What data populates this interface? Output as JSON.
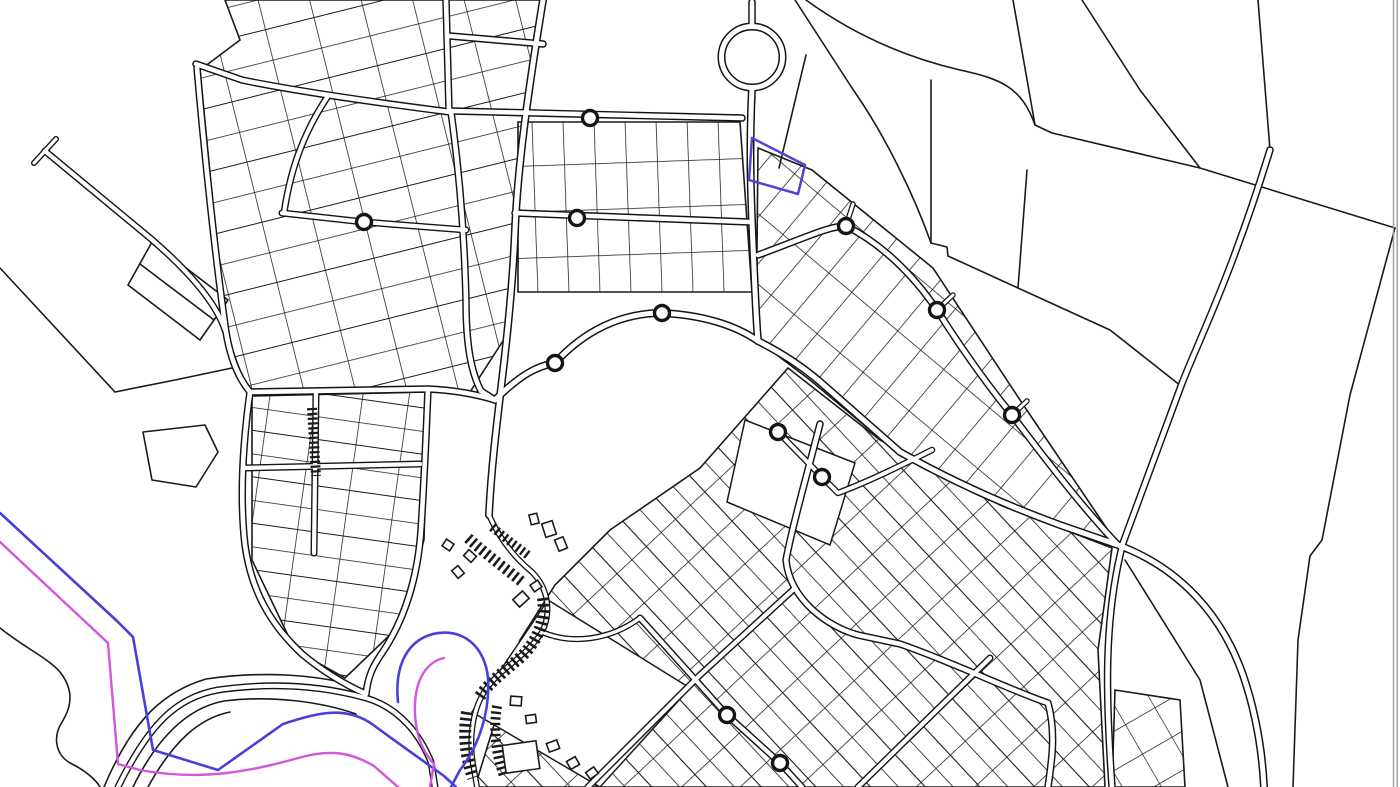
{
  "map": {
    "background": "#ffffff",
    "canvas": {
      "width": 1400,
      "height": 787
    },
    "colors": {
      "parcel_line": "#1a1a1a",
      "road_casing": "#141414",
      "road_fill": "#ffffff",
      "building_fill": "#ffffff",
      "overlay_blue": "#4a3fd8",
      "overlay_magenta": "#d356dd",
      "parcel_highlight_blue": "#5044d4",
      "frame_gray": "#9a9a9a"
    },
    "patterns": [
      {
        "id": "pat_nw",
        "w": 50,
        "h": 62,
        "rot": -14,
        "lines": [
          {
            "d": "M0 0H50",
            "w": 1.5
          },
          {
            "d": "M0 0V62",
            "w": 1.5
          },
          {
            "d": "M0 31H50",
            "w": 1.1
          }
        ]
      },
      {
        "id": "pat_nc",
        "w": 31,
        "h": 46,
        "rot": -2,
        "lines": [
          {
            "d": "M0 0H31",
            "w": 1.5
          },
          {
            "d": "M0 0V46",
            "w": 1.5
          }
        ]
      },
      {
        "id": "pat_fan",
        "w": 30,
        "h": 54,
        "rot": 40,
        "lines": [
          {
            "d": "M0 0H30",
            "w": 1.5
          },
          {
            "d": "M0 0V54",
            "w": 1.5
          }
        ]
      },
      {
        "id": "pat_se",
        "w": 40,
        "h": 40,
        "rot": -43,
        "lines": [
          {
            "d": "M0 0H40",
            "w": 1.6
          },
          {
            "d": "M0 0V40",
            "w": 1.6
          },
          {
            "d": "M20 0V40",
            "w": 1.1
          }
        ]
      },
      {
        "id": "pat_sw",
        "w": 46,
        "h": 46,
        "rot": 8,
        "lines": [
          {
            "d": "M0 0H46",
            "w": 1.5
          },
          {
            "d": "M0 0V46",
            "w": 1.5
          },
          {
            "d": "M0 23H46",
            "w": 1.1
          }
        ]
      },
      {
        "id": "pat_br",
        "w": 34,
        "h": 34,
        "rot": -30,
        "lines": [
          {
            "d": "M0 0H34",
            "w": 1.4
          },
          {
            "d": "M0 0V34",
            "w": 1.4
          }
        ]
      }
    ],
    "zones": [
      {
        "name": "zone-northwest-grid",
        "pattern": "pat_nw",
        "points": "225,0 540,0 514,230 510,330 470,392 248,392 225,330 200,70 240,40"
      },
      {
        "name": "zone-north-center-lots",
        "pattern": "pat_nc",
        "points": "518,122 740,122 752,292 518,292"
      },
      {
        "name": "zone-northeast-fan",
        "pattern": "pat_fan",
        "points": "758,148 812,170 933,268 1020,400 1118,545 1015,510 900,455 810,380 757,340 757,250"
      },
      {
        "name": "zone-southeast-grid",
        "pattern": "pat_se",
        "points": "788,368 880,440 1000,505 1112,548 1098,650 1105,787 475,787 520,640 555,585 610,530 700,468"
      },
      {
        "name": "zone-southwest-grid",
        "pattern": "pat_sw",
        "points": "252,396 428,392 424,540 395,630 345,678 295,650 252,560"
      },
      {
        "name": "zone-bottom-right-lots",
        "pattern": "pat_br",
        "points": "1115,690 1180,700 1185,787 1112,787"
      }
    ],
    "white_blocks": [
      {
        "name": "empty-block-diamond",
        "d": "M548 600 L690 688 L600 787 L472 712 Z"
      },
      {
        "name": "empty-block-center",
        "d": "M745 420 L855 463 L830 545 L727 502 Z"
      }
    ],
    "parcel_lines": [
      {
        "name": "fan-field-boundary",
        "d": "M795 0 L852 88 C885 135 914 195 931 243"
      },
      {
        "name": "field-vertical-boundary",
        "d": "M931 80 L931 243"
      },
      {
        "name": "fan-step-boundary",
        "d": "M931 243 L947 247 L948 256 L1018 288"
      },
      {
        "name": "field-corner-line",
        "d": "M1027 170 L1018 288"
      },
      {
        "name": "fan-outer-edge",
        "d": "M1018 288 L1110 330 L1181 386"
      },
      {
        "name": "north-field-boundary",
        "d": "M806 0 C850 32 900 56 960 70 C1002 79 1022 88 1035 125 L1052 133 L1200 168 L1395 228"
      },
      {
        "name": "field-line-a",
        "d": "M1013 0 L1035 125"
      },
      {
        "name": "field-line-b",
        "d": "M1082 0 L1140 90 L1200 168"
      },
      {
        "name": "east-field-boundary",
        "d": "M1395 228 L1350 395 L1322 540 L1310 556 L1298 640 L1293 787"
      },
      {
        "name": "field-line-c",
        "d": "M1258 0 L1270 150"
      },
      {
        "name": "field-line-d",
        "d": "M1125 560 L1200 680 L1228 787"
      },
      {
        "name": "line-into-blue-parcel",
        "d": "M806 55 L779 168"
      },
      {
        "name": "west-open-boundary",
        "d": "M0 268 L115 392"
      },
      {
        "name": "west-open-boundary-2",
        "d": "M115 392 L175 380 L232 368"
      },
      {
        "name": "pentagon-parcel",
        "d": "M143 432 L205 425 L218 452 L196 487 L152 480 Z"
      },
      {
        "name": "quad-parcel",
        "d": "M152 242 L228 300 L200 340 L128 285 Z"
      },
      {
        "name": "quad-parcel-midline",
        "d": "M140 264 L214 320"
      },
      {
        "name": "coastline",
        "d": "M0 628 C25 648 48 658 60 672 C74 690 72 706 62 722 C52 738 56 756 72 764 C86 771 96 780 100 787"
      },
      {
        "name": "shore-road-thin-1",
        "d": "M133 787 C160 732 192 707 224 701 C272 695 322 702 356 714"
      },
      {
        "name": "shore-road-thin-2",
        "d": "M148 787 C174 740 200 718 230 712"
      },
      {
        "name": "shore-road-thin-3",
        "d": "M104 787 C134 716 166 691 206 679 C268 670 320 676 352 685"
      }
    ],
    "roads": [
      {
        "name": "road-pier-hammer",
        "d": "M34 163 L56 139",
        "casing": 6,
        "fill": 3.2
      },
      {
        "name": "road-pier",
        "d": "M45 151 L150 238 C185 268 215 300 225 330",
        "casing": 7,
        "fill": 4.2
      },
      {
        "name": "road-nw-west-edge",
        "d": "M197 68 C205 160 216 262 226 332 C231 362 240 380 250 392",
        "casing": 7.5,
        "fill": 4.6
      },
      {
        "name": "road-nw-top",
        "d": "M196 64 L242 80 C300 92 380 103 450 112",
        "casing": 7.5,
        "fill": 4.6
      },
      {
        "name": "road-nw-link",
        "d": "M450 36 L543 44",
        "casing": 7.5,
        "fill": 4.6
      },
      {
        "name": "road-nw-north-stub",
        "d": "M446 0 L449 110",
        "casing": 7.5,
        "fill": 4.6
      },
      {
        "name": "road-nw-east-edge",
        "d": "M451 112 C458 162 464 220 466 300 C466 345 471 372 481 391 L495 400",
        "casing": 7.5,
        "fill": 4.6
      },
      {
        "name": "road-nw-interior-1",
        "d": "M328 96 C302 135 290 172 284 213",
        "casing": 7,
        "fill": 4.2
      },
      {
        "name": "road-nw-interior-2",
        "d": "M282 213 L364 222 L466 230",
        "casing": 7,
        "fill": 4.2
      },
      {
        "name": "road-central-spine",
        "d": "M543 0 C530 80 518 160 515 230 C513 280 508 330 502 380 C496 430 491 472 489 515",
        "casing": 8,
        "fill": 5
      },
      {
        "name": "road-nc-upper",
        "d": "M452 111 L742 118",
        "casing": 7.5,
        "fill": 4.6
      },
      {
        "name": "road-nc-lower",
        "d": "M515 213 L749 222",
        "casing": 7.5,
        "fill": 4.6
      },
      {
        "name": "road-roundabout-stub",
        "d": "M752 2 L752 24",
        "casing": 7.5,
        "fill": 4.6
      },
      {
        "name": "road-east-ns",
        "d": "M752 88 C749 150 751 200 753 245 C755 292 756 318 758 341",
        "casing": 8,
        "fill": 5
      },
      {
        "name": "road-crescent",
        "d": "M495 400 C520 375 537 366 555 363 C585 330 622 313 662 313 C702 315 735 325 758 341",
        "casing": 8,
        "fill": 5
      },
      {
        "name": "road-sw-top",
        "d": "M250 392 L428 389 C452 390 472 393 495 400",
        "casing": 7.5,
        "fill": 4.6
      },
      {
        "name": "road-sw-west",
        "d": "M250 392 C242 450 240 502 245 545 C251 590 270 624 302 654 C326 674 348 686 366 694",
        "casing": 7.5,
        "fill": 4.6
      },
      {
        "name": "road-sw-east",
        "d": "M428 389 C426 440 424 482 421 530 C418 574 406 618 382 653 C373 666 368 676 366 694",
        "casing": 7.5,
        "fill": 4.6
      },
      {
        "name": "road-sw-interior-ew",
        "d": "M244 468 L420 464",
        "casing": 7,
        "fill": 4.2
      },
      {
        "name": "road-sw-interior-ns",
        "d": "M316 392 L314 553",
        "casing": 7,
        "fill": 4.2
      },
      {
        "name": "road-waterfront",
        "d": "M118 787 C150 722 178 697 218 690 C280 681 330 688 366 698 C400 708 420 735 431 762 L435 787",
        "casing": 7,
        "fill": 4.2
      },
      {
        "name": "road-oldtown-loop",
        "d": "M489 515 C500 540 515 558 532 572 C548 588 552 612 542 632 C524 660 498 668 483 694 C472 713 469 740 473 764 L477 787",
        "casing": 6,
        "fill": 3.4
      },
      {
        "name": "road-oldtown-link",
        "d": "M542 632 C572 645 610 640 640 618",
        "casing": 6,
        "fill": 3.4
      },
      {
        "name": "road-fan-arc",
        "d": "M758 255 C800 240 828 226 846 226 C880 243 912 273 937 310 C958 343 985 382 1012 415 C1040 452 1080 505 1118 545",
        "casing": 7.5,
        "fill": 4.6
      },
      {
        "name": "road-fan-stub-1",
        "d": "M846 226 L853 204",
        "casing": 5.5,
        "fill": 3
      },
      {
        "name": "road-fan-stub-2",
        "d": "M937 310 L953 295",
        "casing": 5.5,
        "fill": 3
      },
      {
        "name": "road-fan-stub-3",
        "d": "M1012 415 L1027 401",
        "casing": 5.5,
        "fill": 3
      },
      {
        "name": "road-main-diagonal",
        "d": "M758 341 C780 352 800 365 818 380 L900 452 C950 480 1005 505 1060 525 L1118 545 C1180 568 1222 615 1243 675 C1255 710 1262 748 1264 787",
        "casing": 8,
        "fill": 5
      },
      {
        "name": "road-ne-sw-diagonal",
        "d": "M1270 150 C1230 280 1196 346 1181 386 L1123 543 C1103 620 1106 700 1112 787",
        "casing": 7.5,
        "fill": 4.6
      },
      {
        "name": "road-se-loop",
        "d": "M820 424 C806 478 792 528 786 560 C790 600 828 627 858 635 L900 644 C950 661 1012 691 1048 703 C1056 732 1052 760 1048 787",
        "casing": 7.5,
        "fill": 4.6
      },
      {
        "name": "road-se-street-1",
        "d": "M640 618 L727 715 L780 763 L802 787",
        "casing": 7,
        "fill": 4.2
      },
      {
        "name": "road-se-street-2",
        "d": "M588 787 L700 675 L795 588",
        "casing": 7,
        "fill": 4.2
      },
      {
        "name": "road-se-street-3",
        "d": "M858 787 L990 658",
        "casing": 7,
        "fill": 4.2
      },
      {
        "name": "road-se-street-4",
        "d": "M778 432 L822 477 L838 493 C870 481 906 463 932 450",
        "casing": 6.5,
        "fill": 3.8
      }
    ],
    "roundabout": {
      "cx": 752,
      "cy": 57,
      "r": 30.5,
      "casing": 8,
      "fill": 5
    },
    "mini_circles": [
      [
        590,
        118
      ],
      [
        577,
        218
      ],
      [
        364,
        222
      ],
      [
        555,
        363
      ],
      [
        662,
        313
      ],
      [
        846,
        226
      ],
      [
        937,
        310
      ],
      [
        1012,
        415
      ],
      [
        778,
        432
      ],
      [
        822,
        477
      ],
      [
        727,
        715
      ],
      [
        780,
        763
      ]
    ],
    "mini_circle_r": {
      "outer": 9.2,
      "inner": 5.8
    },
    "building_rows": [
      {
        "name": "oldtown-row-upper",
        "d": "M468 538 C488 556 505 568 522 582",
        "w": 11,
        "dash": "2.6 3.4"
      },
      {
        "name": "oldtown-row-inner",
        "d": "M543 598 C546 620 538 640 522 656 C505 671 488 683 479 698",
        "w": 12,
        "dash": "2.6 3.4"
      },
      {
        "name": "oldtown-row-lower",
        "d": "M467 712 C463 736 466 757 473 778",
        "w": 12,
        "dash": "2.6 3.4"
      },
      {
        "name": "oldtown-row-top",
        "d": "M492 527 C505 538 516 546 529 556",
        "w": 9,
        "dash": "2.4 3"
      },
      {
        "name": "oldtown-row-bottom",
        "d": "M497 706 C493 730 496 754 504 776",
        "w": 10,
        "dash": "2.4 3.2"
      },
      {
        "name": "hatched-strip",
        "d": "M312 408 L316 476",
        "w": 10,
        "dash": "2.2 2.6"
      }
    ],
    "buildings": [
      [
        549,
        529,
        11,
        14,
        -18
      ],
      [
        561,
        544,
        9,
        12,
        -22
      ],
      [
        534,
        519,
        8,
        10,
        -14
      ],
      [
        521,
        599,
        13,
        10,
        -42
      ],
      [
        536,
        586,
        9,
        8,
        -34
      ],
      [
        470,
        556,
        10,
        8,
        42
      ],
      [
        458,
        572,
        10,
        8,
        50
      ],
      [
        448,
        545,
        9,
        8,
        34
      ],
      [
        516,
        701,
        11,
        9,
        4
      ],
      [
        531,
        719,
        10,
        8,
        -8
      ],
      [
        553,
        746,
        11,
        9,
        -20
      ],
      [
        573,
        763,
        10,
        9,
        -30
      ],
      [
        592,
        773,
        10,
        8,
        -36
      ],
      [
        521,
        757,
        34,
        28,
        -8
      ]
    ],
    "overlays": [
      {
        "name": "overlay-blue-coast-line",
        "color": "overlay_blue",
        "w": 2.6,
        "d": "M0 513 L117 621 L133 637 L153 750 L218 770 L283 724 C320 712 346 706 372 724 C392 739 418 757 444 776 L456 787"
      },
      {
        "name": "overlay-blue-oldtown-loop",
        "color": "overlay_blue",
        "w": 2.6,
        "d": "M398 702 C394 662 410 640 433 634 C462 627 485 646 488 678 C490 712 479 746 460 770 L451 787"
      },
      {
        "name": "overlay-magenta-coast-line",
        "color": "overlay_magenta",
        "w": 2.4,
        "d": "M0 542 L108 643 L118 764 L140 770 C205 782 255 770 302 757 C332 749 352 753 374 766 L398 787"
      },
      {
        "name": "overlay-magenta-oldtown-arc",
        "color": "overlay_magenta",
        "w": 2.4,
        "d": "M444 658 C426 662 416 680 415 704 C414 730 421 750 434 764 L430 787"
      },
      {
        "name": "highlighted-parcel-blue",
        "color": "parcel_highlight_blue",
        "w": 2.5,
        "d": "M752 138 L805 165 L798 194 L749 180 Z"
      }
    ],
    "frame": {
      "lines_x": [
        1393.5,
        1397.2
      ],
      "w": 1.4
    }
  }
}
